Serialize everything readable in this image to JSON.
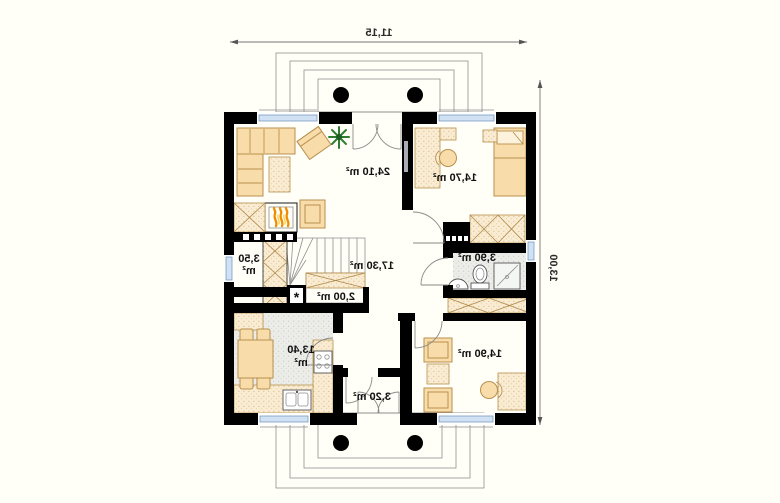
{
  "rooms": {
    "living": {
      "label": "24,10 m²"
    },
    "bedroom": {
      "label": "14,70 m²"
    },
    "hall": {
      "label": "17,30 m²"
    },
    "bathroom": {
      "label": "3,90 m²"
    },
    "storage": {
      "line1": "3,50",
      "line2": "m²"
    },
    "closet": {
      "label": "2,00 m²"
    },
    "kitchen": {
      "line1": "13,40",
      "line2": "m²"
    },
    "vestibule": {
      "label": "3,20 m²"
    },
    "room2": {
      "label": "14,90 m²"
    }
  },
  "dimensions": {
    "overall_width": "11,15",
    "overall_depth": "13,00"
  },
  "symbols": {
    "utility_marker": "*"
  },
  "colors": {
    "wall": "#000000",
    "furniture_fill": "#f8dcaa",
    "furniture_stroke": "#b8904e",
    "floor_speckle": "#f9ecd3",
    "tile_floor": "#ecede9",
    "window_glass": "#cfe1f2",
    "flame": "#f08c00",
    "plant": "#2f7d33",
    "text": "#111111",
    "dimension_line": "#777777"
  }
}
